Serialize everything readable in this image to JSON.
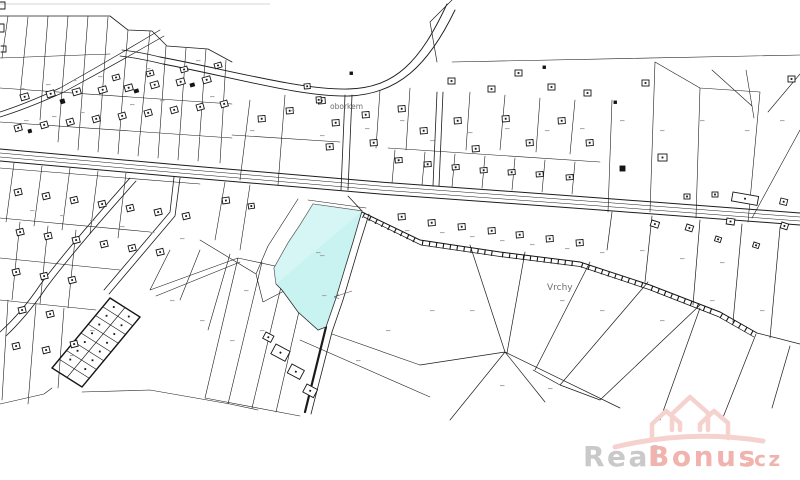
{
  "map": {
    "description": "cadastral parcel map with one highlighted parcel",
    "labels": {
      "street": "oborkem",
      "area": "Vrchy"
    }
  },
  "watermark": {
    "brand_primary": "Real",
    "brand_secondary": "Bonus",
    "tld": ".cz"
  },
  "colors": {
    "line": "#1b1b1b",
    "highlight": "#c8f3f0",
    "highlight_light": "#dcf8f6",
    "label_gray": "#9a9a9a",
    "watermark_gray": "#c9c9c9",
    "watermark_pink": "#f0b3ae",
    "watermark_pink_light": "#f6d2cf",
    "background": "#ffffff"
  }
}
